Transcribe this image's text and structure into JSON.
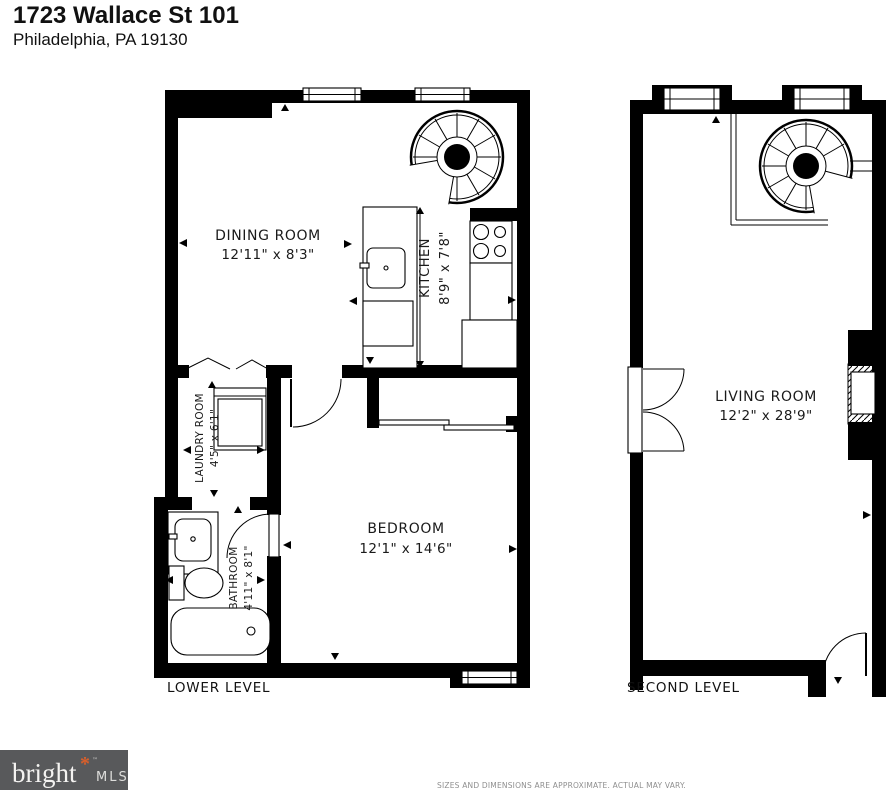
{
  "header": {
    "title": "1723 Wallace St 101",
    "subtitle": "Philadelphia, PA 19130"
  },
  "plans": {
    "lower": {
      "level_label": "LOWER LEVEL",
      "rooms": {
        "dining": {
          "name": "DINING ROOM",
          "dims": "12'11\" x 8'3\""
        },
        "kitchen": {
          "name": "KITCHEN",
          "dims": "8'9\" x 7'8\""
        },
        "laundry": {
          "name": "LAUNDRY ROOM",
          "dims": "4'5\" x 6'1\""
        },
        "bathroom": {
          "name": "BATHROOM",
          "dims": "4'11\" x 8'1\""
        },
        "bedroom": {
          "name": "BEDROOM",
          "dims": "12'1\" x 14'6\""
        }
      }
    },
    "second": {
      "level_label": "SECOND LEVEL",
      "rooms": {
        "living": {
          "name": "LIVING ROOM",
          "dims": "12'2\" x 28'9\""
        }
      }
    }
  },
  "footer": {
    "logo": {
      "brand": "bright",
      "accent": "*",
      "tm": "™",
      "suffix": "MLS"
    },
    "disclaimer": "SIZES AND DIMENSIONS ARE APPROXIMATE. ACTUAL MAY VARY."
  },
  "colors": {
    "wall": "#000000",
    "logo_bg": "#58595b",
    "logo_accent": "#d95f2b"
  }
}
